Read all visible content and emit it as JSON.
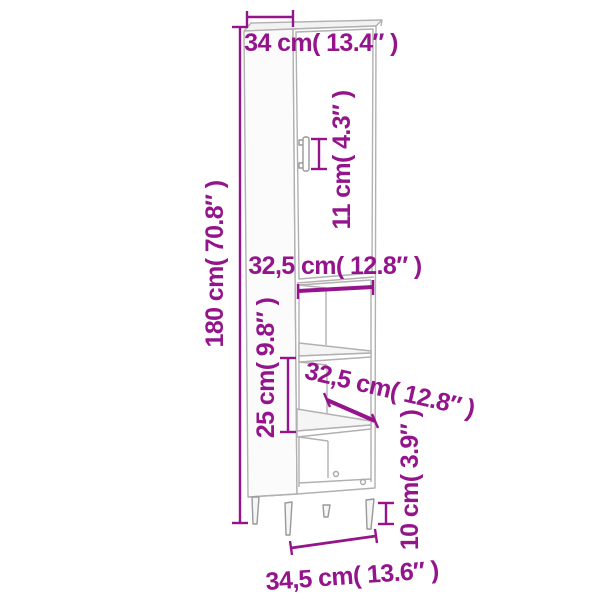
{
  "figure": {
    "subject": "tall-cabinet-dimension-diagram",
    "accent_color": "#94148C",
    "outline_color": "#b2b0b2",
    "labels": {
      "top_depth": "34 cm( 13.4″ )",
      "handle_height": "11 cm( 4.3″ )",
      "total_height": "180 cm( 70.8″ )",
      "inner_width": "32,5 cm( 12.8″ )",
      "shelf_spacing": "25 cm( 9.8″ )",
      "shelf_depth": "32,5 cm( 12.8″ )",
      "leg_height": "10 cm( 3.9″ )",
      "total_width": "34,5 cm( 13.6″ )"
    }
  }
}
